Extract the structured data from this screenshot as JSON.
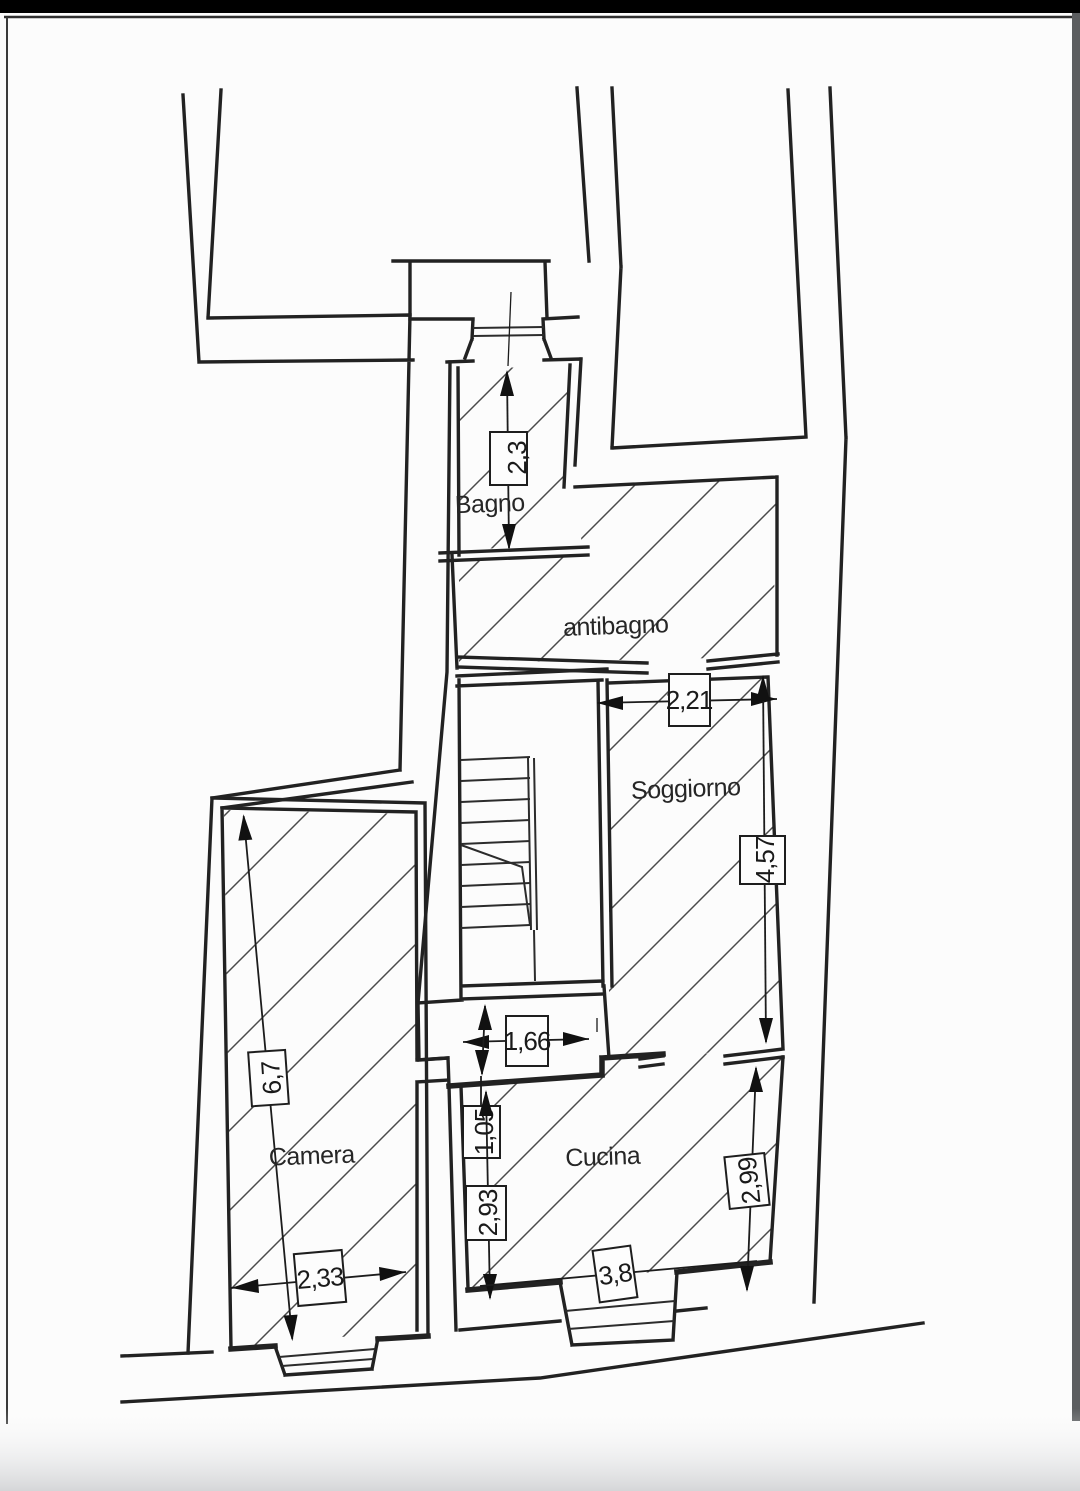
{
  "page": {
    "background": "#fcfcfc",
    "frame_color": "#000000",
    "line_color": "#222222",
    "hatch_color": "#4a4a4a"
  },
  "plan": {
    "rooms": [
      {
        "id": "bagno",
        "label": "Bagno"
      },
      {
        "id": "antibagno",
        "label": "antibagno"
      },
      {
        "id": "soggiorno",
        "label": "Soggiorno"
      },
      {
        "id": "camera",
        "label": "Camera"
      },
      {
        "id": "cucina",
        "label": "Cucina"
      }
    ],
    "dimensions": [
      {
        "id": "bagno-height",
        "value": "2,3"
      },
      {
        "id": "soggiorno-width",
        "value": "2,21"
      },
      {
        "id": "soggiorno-height",
        "value": "4,57"
      },
      {
        "id": "camera-height",
        "value": "6,7"
      },
      {
        "id": "camera-width",
        "value": "2,33"
      },
      {
        "id": "passage-width",
        "value": "1,66"
      },
      {
        "id": "passage-height",
        "value": "1,05"
      },
      {
        "id": "cucina-height",
        "value": "2,93"
      },
      {
        "id": "cucina-right-height",
        "value": "2,99"
      },
      {
        "id": "cucina-width",
        "value": "3,8"
      }
    ]
  }
}
